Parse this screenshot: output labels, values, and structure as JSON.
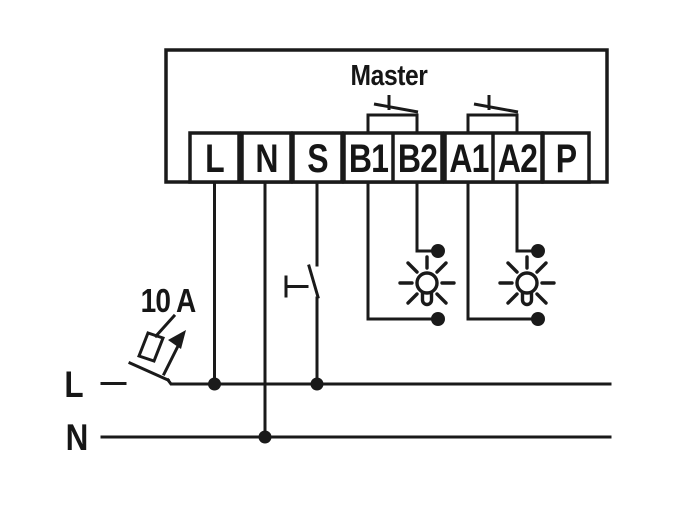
{
  "colors": {
    "line": "#1a1a1a",
    "background": "#ffffff"
  },
  "device": {
    "master_label": "Master",
    "terminals": [
      {
        "label": "L"
      },
      {
        "label": "N"
      },
      {
        "label": "S"
      },
      {
        "label": "B1"
      },
      {
        "label": "B2"
      },
      {
        "label": "A1"
      },
      {
        "label": "A2"
      },
      {
        "label": "P"
      }
    ]
  },
  "supply": {
    "breaker_rating": "10 A",
    "phase_label": "L",
    "neutral_label": "N"
  },
  "icons": [
    "circuit-breaker-icon",
    "push-button-icon",
    "relay-contact-icon",
    "lamp-icon",
    "junction-dot"
  ]
}
